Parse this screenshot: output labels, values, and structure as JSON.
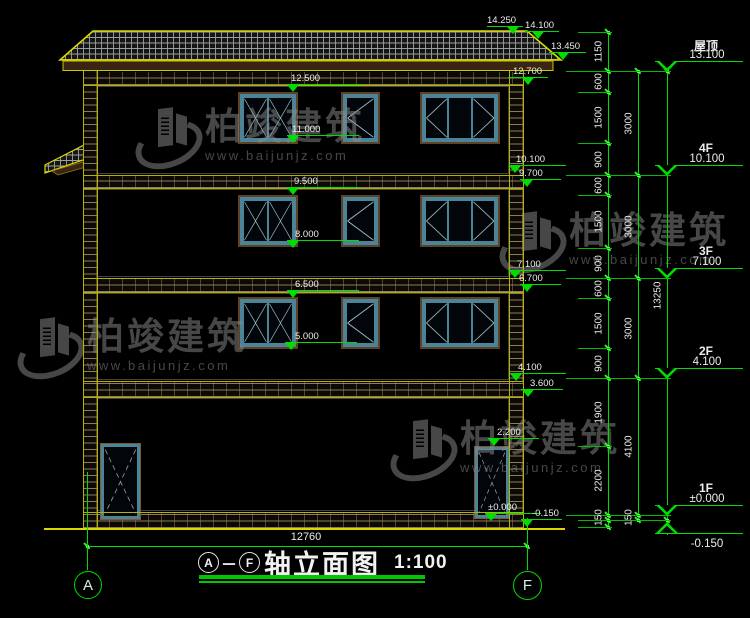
{
  "drawing_title": {
    "axis_from": "A",
    "separator": "－",
    "axis_to": "F",
    "name": "轴立面图",
    "scale": "1:100"
  },
  "bottom_dimension": "12760",
  "axis_bubbles": [
    {
      "label": "A"
    },
    {
      "label": "F"
    }
  ],
  "watermark": {
    "brand": "柏竣建筑",
    "url": "www.baijunjz.com"
  },
  "colors": {
    "dim_green": "#00dd00",
    "outline_yellow": "#d9d900",
    "text_white": "#ececec",
    "window_teal": "#4a8496",
    "frame_brown": "#5d4227",
    "watermark_gray": "#8d8d8d"
  },
  "floor_levels": [
    {
      "name": "屋顶",
      "elevation": "13.100",
      "y": 71,
      "dir": "down"
    },
    {
      "name": "4F",
      "elevation": "10.100",
      "y": 175,
      "dir": "down"
    },
    {
      "name": "3F",
      "elevation": "7.100",
      "y": 278,
      "dir": "down"
    },
    {
      "name": "2F",
      "elevation": "4.100",
      "y": 378,
      "dir": "down"
    },
    {
      "name": "1F",
      "elevation": "±0.000",
      "y": 515,
      "dir": "down"
    },
    {
      "name": "",
      "elevation": "-0.150",
      "y": 521,
      "dir": "up"
    }
  ],
  "spot_elevations": [
    {
      "label": "14.250",
      "x": 513,
      "y": 34,
      "lx": 487,
      "len": 36,
      "tx": -26
    },
    {
      "label": "14.100",
      "x": 538,
      "y": 39,
      "lx": 525,
      "len": 34,
      "tx": -13
    },
    {
      "label": "13.450",
      "x": 563,
      "y": 60,
      "lx": 549,
      "len": 37,
      "tx": -12
    },
    {
      "label": "12.700",
      "x": 528,
      "y": 85,
      "lx": 508,
      "len": 40,
      "tx": -15
    },
    {
      "label": "12.500",
      "x": 293,
      "y": 92,
      "lx": 287,
      "len": 75,
      "tx": -2
    },
    {
      "label": "11.000",
      "x": 293,
      "y": 143,
      "lx": 287,
      "len": 72,
      "tx": -1
    },
    {
      "label": "9.500",
      "x": 293,
      "y": 195,
      "lx": 287,
      "len": 72,
      "tx": 1
    },
    {
      "label": "8.000",
      "x": 293,
      "y": 248,
      "lx": 287,
      "len": 72,
      "tx": 2
    },
    {
      "label": "6.500",
      "x": 293,
      "y": 298,
      "lx": 287,
      "len": 72,
      "tx": 2
    },
    {
      "label": "5.000",
      "x": 291,
      "y": 350,
      "lx": 285,
      "len": 72,
      "tx": 4
    },
    {
      "label": "10.100",
      "x": 515,
      "y": 173,
      "lx": 509,
      "len": 57,
      "tx": 1
    },
    {
      "label": "9.700",
      "x": 527,
      "y": 187,
      "lx": 520,
      "len": 41,
      "tx": -8
    },
    {
      "label": "7.100",
      "x": 515,
      "y": 278,
      "lx": 509,
      "len": 57,
      "tx": 2
    },
    {
      "label": "6.700",
      "x": 527,
      "y": 292,
      "lx": 520,
      "len": 41,
      "tx": -8
    },
    {
      "label": "4.100",
      "x": 516,
      "y": 381,
      "lx": 510,
      "len": 56,
      "tx": 2
    },
    {
      "label": "3.600",
      "x": 528,
      "y": 397,
      "lx": 521,
      "len": 42,
      "tx": 2
    },
    {
      "label": "2.200",
      "x": 494,
      "y": 446,
      "lx": 488,
      "len": 51,
      "tx": 3
    },
    {
      "label": "±0.000",
      "x": 491,
      "y": 521,
      "lx": 485,
      "len": 56,
      "tx": -3
    },
    {
      "label": "-0.150",
      "x": 527,
      "y": 527,
      "lx": 521,
      "len": 41,
      "tx": 5
    }
  ],
  "dim_chains": [
    {
      "x": 608,
      "bounds": [
        32,
        71,
        92,
        143,
        175,
        195,
        248,
        278,
        298,
        348,
        378,
        446,
        515,
        520,
        527
      ],
      "labels": [
        "1150",
        "600",
        "1500",
        "900",
        "600",
        "1500",
        "900",
        "600",
        "1500",
        "900",
        "1900",
        "2200",
        "150",
        ""
      ]
    },
    {
      "x": 638,
      "bounds": [
        71,
        175,
        278,
        378,
        515,
        520
      ],
      "labels": [
        "3000",
        "3000",
        "3000",
        "4100",
        "150"
      ]
    },
    {
      "x": 667,
      "bounds": [
        71,
        520
      ],
      "labels": [
        "13250"
      ],
      "line_start": 63,
      "line_end": 535
    }
  ],
  "geometry": {
    "piers": [
      {
        "x": 83,
        "y": 71,
        "w": 14,
        "h": 457
      },
      {
        "x": 509,
        "y": 71,
        "w": 14,
        "h": 457
      }
    ],
    "bands": [
      {
        "y": 72,
        "h": 13
      },
      {
        "y": 175,
        "h": 13
      },
      {
        "y": 278,
        "h": 14
      },
      {
        "y": 381,
        "h": 16
      },
      {
        "y": 512,
        "h": 16
      }
    ],
    "band_x": 83,
    "band_w": 440,
    "interiors": [
      {
        "y": 86,
        "h": 88
      },
      {
        "y": 189,
        "h": 88
      },
      {
        "y": 293,
        "h": 87
      },
      {
        "y": 398,
        "h": 113
      }
    ],
    "yellow_lines": [
      85,
      175,
      188,
      278,
      292,
      381,
      397,
      512,
      528
    ],
    "windows": [
      {
        "x": 238,
        "y": 92,
        "w": 60,
        "h": 52,
        "panes": [
          "x",
          "x"
        ]
      },
      {
        "x": 341,
        "y": 92,
        "w": 39,
        "h": 52,
        "panes": [
          "lt"
        ]
      },
      {
        "x": 420,
        "y": 92,
        "w": 80,
        "h": 52,
        "panes": [
          "lt",
          "",
          "rt"
        ]
      },
      {
        "x": 238,
        "y": 195,
        "w": 60,
        "h": 52,
        "panes": [
          "x",
          "x"
        ]
      },
      {
        "x": 341,
        "y": 195,
        "w": 39,
        "h": 52,
        "panes": [
          "lt"
        ]
      },
      {
        "x": 420,
        "y": 195,
        "w": 80,
        "h": 52,
        "panes": [
          "lt",
          "",
          "rt"
        ]
      },
      {
        "x": 238,
        "y": 297,
        "w": 60,
        "h": 52,
        "panes": [
          "x",
          "x"
        ]
      },
      {
        "x": 341,
        "y": 297,
        "w": 39,
        "h": 52,
        "panes": [
          "lt"
        ]
      },
      {
        "x": 420,
        "y": 297,
        "w": 80,
        "h": 52,
        "panes": [
          "lt",
          "",
          "rt"
        ]
      }
    ],
    "doors": [
      {
        "x": 100,
        "y": 443,
        "w": 41,
        "h": 77
      },
      {
        "x": 474,
        "y": 446,
        "w": 36,
        "h": 73
      }
    ],
    "stubs": [
      [
        32,
        578,
        612
      ],
      [
        71,
        566,
        671
      ],
      [
        92,
        578,
        612
      ],
      [
        143,
        578,
        612
      ],
      [
        175,
        566,
        671
      ],
      [
        195,
        578,
        612
      ],
      [
        248,
        578,
        612
      ],
      [
        278,
        566,
        671
      ],
      [
        298,
        578,
        612
      ],
      [
        348,
        578,
        612
      ],
      [
        378,
        566,
        671
      ],
      [
        446,
        578,
        612
      ],
      [
        515,
        566,
        671
      ],
      [
        520,
        578,
        671
      ],
      [
        527,
        578,
        612
      ]
    ],
    "bottom_dim": {
      "y": 546,
      "x1": 87,
      "x2": 527
    },
    "axis_lines": [
      {
        "x": 87,
        "y1": 472,
        "y2": 570
      },
      {
        "x": 527,
        "y1": 518,
        "y2": 570
      }
    ],
    "axis_bubbles": [
      {
        "x": 74,
        "y": 571,
        "d": 26
      },
      {
        "x": 513,
        "y": 571,
        "d": 27
      }
    ],
    "ground_line": {
      "x": 44,
      "y": 528,
      "w": 521
    }
  }
}
